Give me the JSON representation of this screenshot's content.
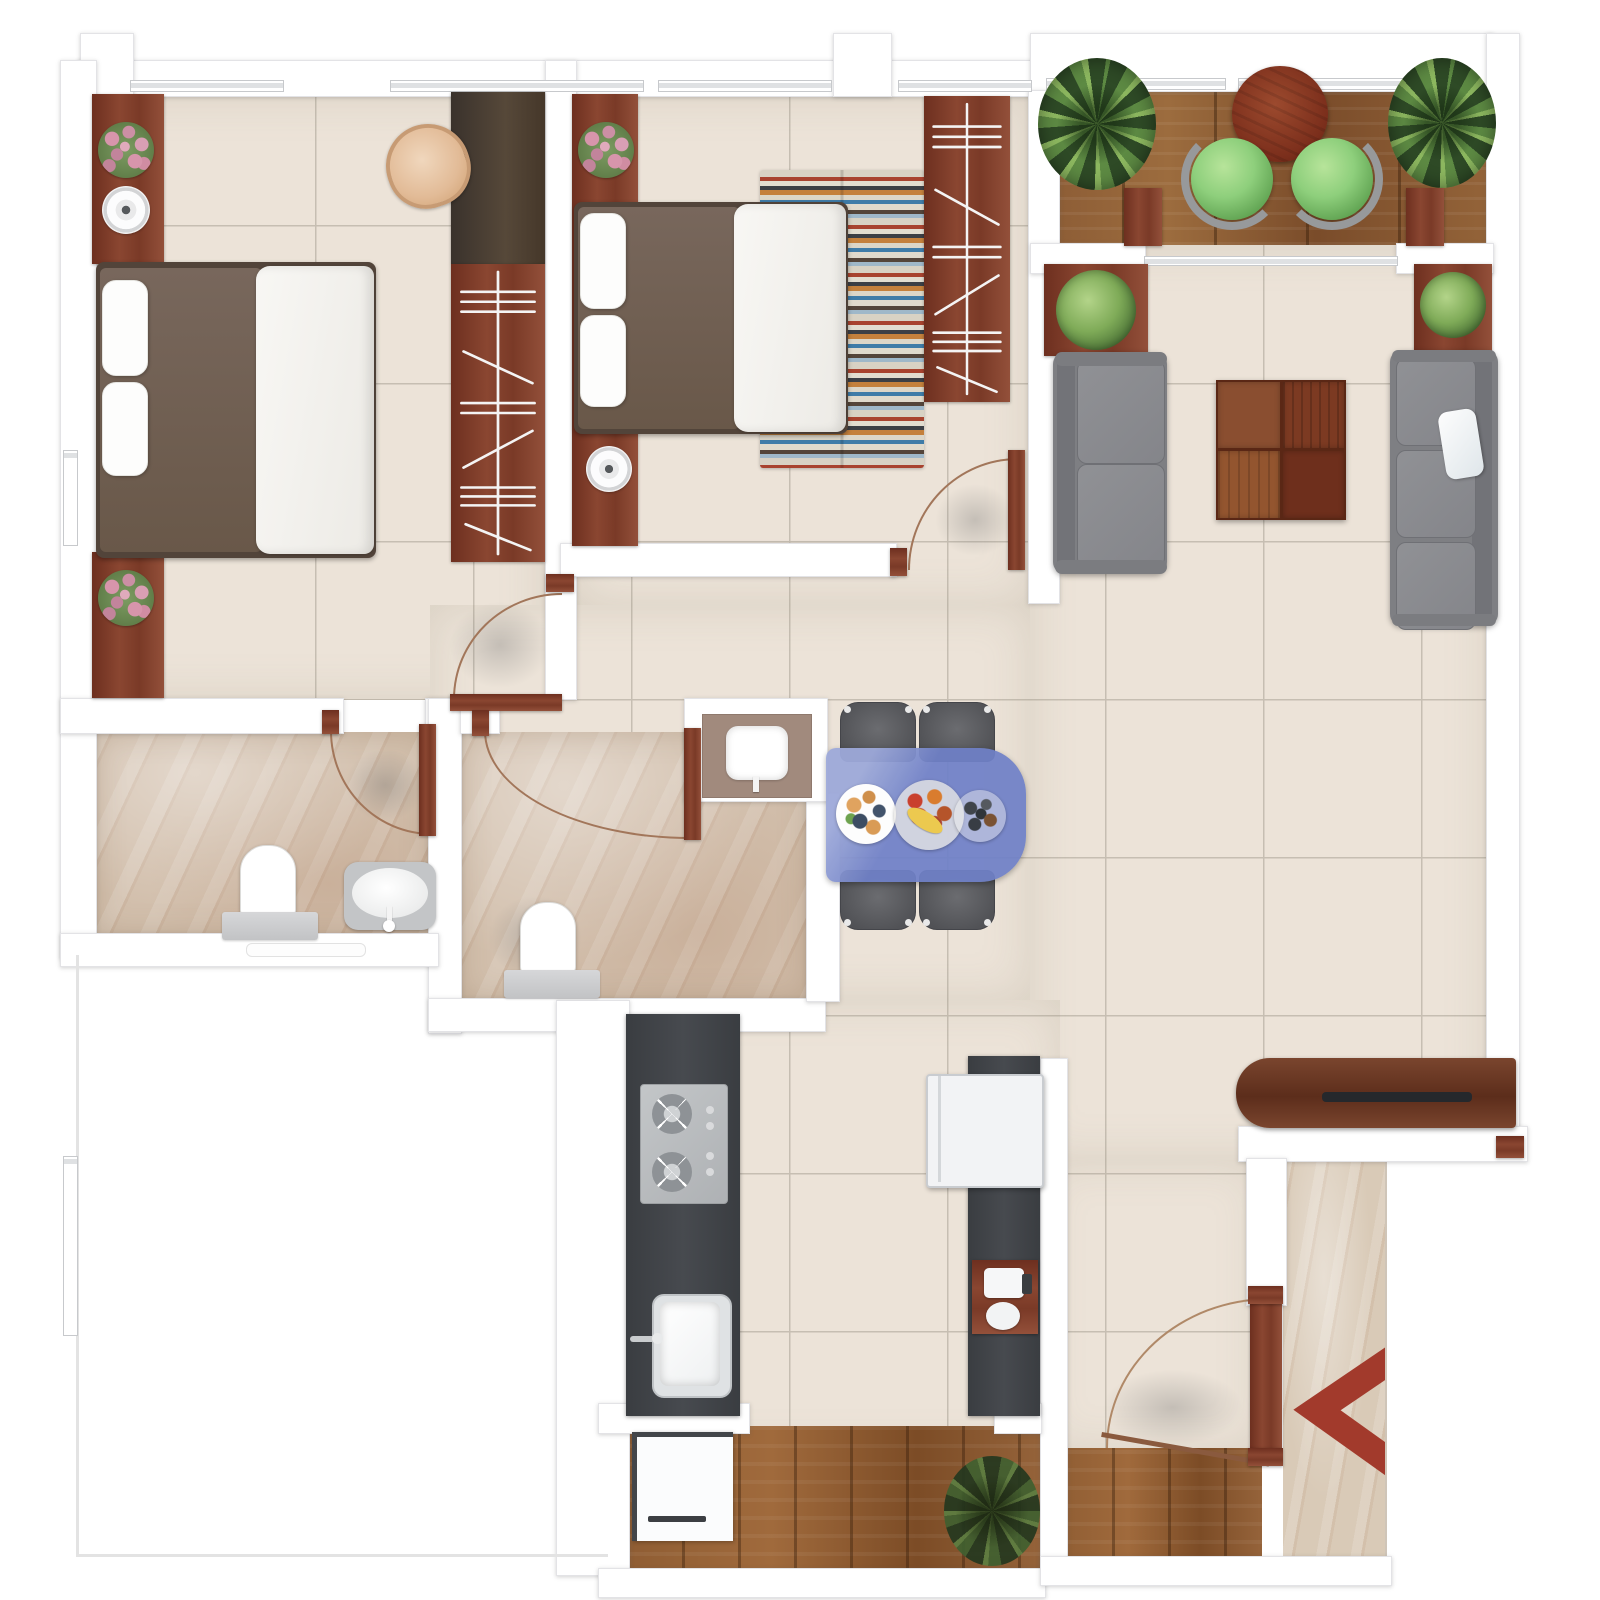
{
  "meta": {
    "kind": "apartment-floor-plan",
    "view": "top-down-3d-render",
    "canvas": "1600x1600"
  },
  "palette": {
    "tile": "#ece3d8",
    "grout": "#c6beb2",
    "marble": "#d2bfac",
    "entry_marble": "#d9cab7",
    "deck_wood": "#8a5a34",
    "plank_wood": "#8f5d33",
    "mahogany": "#7b3b28",
    "wall_white": "#ffffff",
    "wall_edge": "#e3e3e6",
    "dark_counter": "#404349",
    "steel": "#b7babd",
    "fridge_white": "#f2f3f5",
    "sofa_gray": "#87888c",
    "dining_chair_gray": "#56575b",
    "dining_table_blue": "#6f80c7",
    "balcony_seat_green": "#8ed07e",
    "plant_green": "#5d8a43",
    "flower_pink": "#d795ab",
    "arrow_red": "#a23a2c",
    "blanket_brown": "#6f5e52",
    "duvet_white": "#f8f7f5",
    "tan_chair": "#e6c1a4",
    "tv_console_wood": "#6b3723"
  },
  "rooms": [
    {
      "id": "bedroom-1",
      "floor": "beige-tile",
      "furniture": [
        "double-bed",
        "two-pillows",
        "side-console-with-flowers",
        "side-console-with-speaker",
        "desk",
        "tan-desk-chair",
        "wardrobe-with-hangers"
      ]
    },
    {
      "id": "bedroom-2",
      "floor": "beige-tile",
      "furniture": [
        "double-bed",
        "two-pillows",
        "side-console-with-flowers",
        "side-console-with-speaker",
        "striped-rug",
        "wardrobe-with-hangers",
        "swing-door"
      ]
    },
    {
      "id": "balcony",
      "floor": "wood-deck",
      "furniture": [
        "round-table",
        "green-chair",
        "green-chair",
        "corner-plant",
        "corner-plant",
        "planter-box",
        "planter-box"
      ]
    },
    {
      "id": "living-room",
      "floor": "beige-tile",
      "furniture": [
        "two-seat-sofa",
        "three-seat-sofa",
        "white-throw-pillow",
        "square-coffee-table",
        "planter-with-plant",
        "planter-with-plant"
      ]
    },
    {
      "id": "dining",
      "floor": "beige-tile",
      "furniture": [
        "blue-dining-table",
        "dining-chair",
        "dining-chair",
        "dining-chair",
        "dining-chair",
        "fruit-plate",
        "fruit-plate",
        "snack-plate"
      ]
    },
    {
      "id": "bathroom-1",
      "floor": "marble",
      "furniture": [
        "toilet",
        "washbasin",
        "swing-door",
        "wall-shelf"
      ]
    },
    {
      "id": "bathroom-2",
      "floor": "marble",
      "furniture": [
        "toilet",
        "swing-door"
      ]
    },
    {
      "id": "wash-nook",
      "floor": "counter",
      "furniture": [
        "washbasin"
      ]
    },
    {
      "id": "kitchen",
      "floor": "beige-tile",
      "furniture": [
        "counter-run-left",
        "gas-hob-2-burners",
        "kitchen-sink",
        "counter-run-right",
        "refrigerator",
        "coffee-station"
      ]
    },
    {
      "id": "utility-balcony",
      "floor": "wood-plank",
      "furniture": [
        "washing-machine",
        "floor-plant"
      ]
    },
    {
      "id": "foyer",
      "floor": "wood-plank",
      "furniture": [
        "main-entry-door",
        "tv-console-with-slot"
      ]
    },
    {
      "id": "entrance-corridor",
      "floor": "marble",
      "furniture": [
        "entry-arrow"
      ]
    }
  ],
  "doors": [
    {
      "room": "bedroom-1",
      "type": "swing",
      "material": "mahogany"
    },
    {
      "room": "bedroom-2",
      "type": "swing",
      "material": "mahogany"
    },
    {
      "room": "bathroom-1",
      "type": "swing",
      "material": "mahogany"
    },
    {
      "room": "bathroom-2",
      "type": "swing",
      "material": "mahogany"
    },
    {
      "room": "foyer",
      "type": "swing-main-entry",
      "material": "mahogany"
    }
  ],
  "windows": {
    "top_wall": 4,
    "balcony_wall": 2,
    "left_wall": 2,
    "balcony_opening_sill": 1
  },
  "entry": {
    "arrow_direction": "left",
    "arrow_color": "#a23a2c"
  },
  "counts": {
    "bedrooms": 2,
    "bathrooms": 2,
    "sofas": 2,
    "dining_chairs": 4,
    "balcony_chairs": 2,
    "plants": 8,
    "burners": 2
  }
}
